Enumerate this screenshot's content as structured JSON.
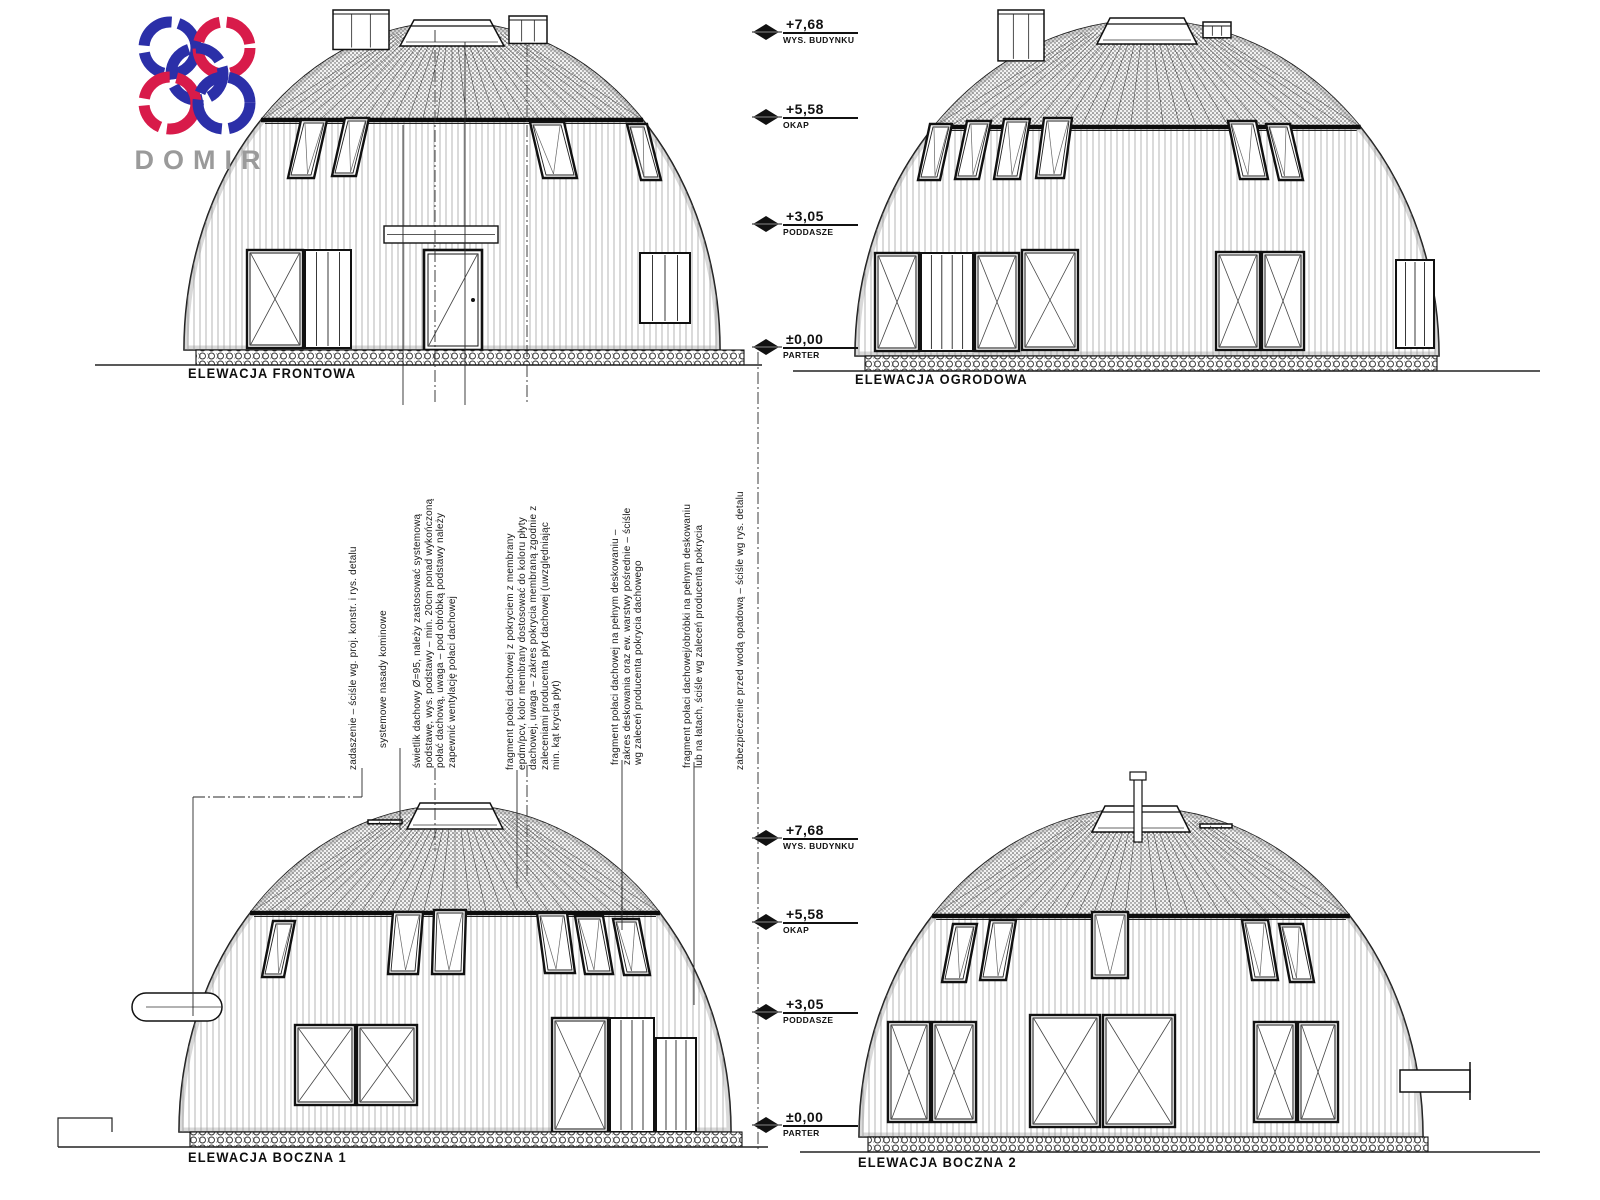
{
  "logo": {
    "text": "DOMIR"
  },
  "elevations": [
    {
      "label": "ELEWACJA FRONTOWA"
    },
    {
      "label": "ELEWACJA OGRODOWA"
    },
    {
      "label": "ELEWACJA BOCZNA 1"
    },
    {
      "label": "ELEWACJA BOCZNA 2"
    }
  ],
  "dimension_markers": {
    "top": [
      {
        "value": "+7,68",
        "label": "WYS. BUDYNKU"
      },
      {
        "value": "+5,58",
        "label": "OKAP"
      },
      {
        "value": "+3,05",
        "label": "PODDASZE"
      },
      {
        "value": "±0,00",
        "label": "PARTER"
      }
    ],
    "bottom": [
      {
        "value": "+7,68",
        "label": "WYS. BUDYNKU"
      },
      {
        "value": "+5,58",
        "label": "OKAP"
      },
      {
        "value": "+3,05",
        "label": "PODDASZE"
      },
      {
        "value": "±0,00",
        "label": "PARTER"
      }
    ]
  },
  "annotations": [
    "zadaszenie – ściśle wg. proj. konstr. i rys. detalu",
    "systemowe nasady kominowe",
    "świetlik dachowy Ø=95, należy zastosować systemową\npodstawę, wys. podstawy – min. 20cm ponad wykończoną\npołać dachową, uwaga – pod obróbką podstawy należy\nzapewnić wentylację połaci dachowej",
    "fragment połaci dachowej z pokryciem z membrany\nepdm/pcv, kolor membrany dostosować do koloru płyty\ndachowej, uwaga – zakres pokrycia membraną zgodnie z\nzaleceniami producenta płyt dachowej (uwzględniając\nmin. kąt krycia płyt)",
    "fragment połaci dachowej na pełnym deskowaniu –\nzakres deskowania oraz ew. warstwy pośrednie – ściśle\nwg zaleceń producenta pokrycia dachowego",
    "fragment połaci dachowej/obróbki na pełnym deskowaniu\nlub na łatach, ściśle wg zaleceń producenta pokrycia",
    "zabezpieczenie przed wodą opadową – ściśle wg rys. detalu"
  ],
  "colors": {
    "line": "#1a1a1a",
    "logo_blue": "#2b2fa8",
    "logo_red": "#d81b4a",
    "logo_gray": "#9a9a9a"
  }
}
